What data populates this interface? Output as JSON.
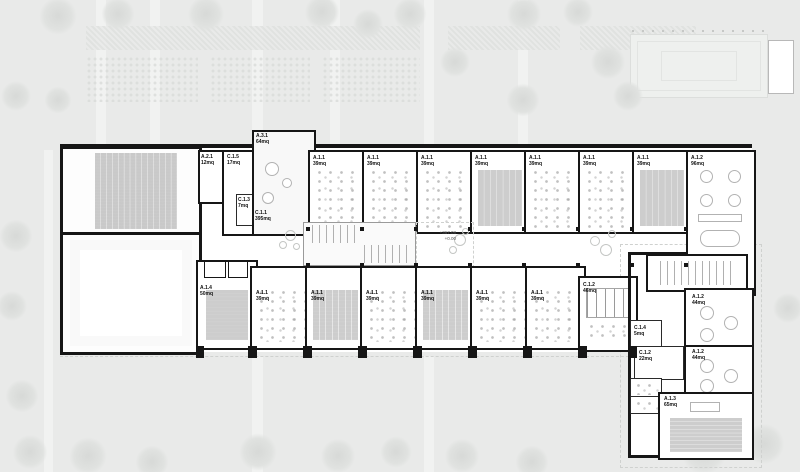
{
  "site": {
    "levels": {
      "upper": "+367.08",
      "zero": "+0.00"
    }
  },
  "rooms": [
    {
      "id": "A.2.1",
      "area": "12mq"
    },
    {
      "id": "C.1.5",
      "area": "17mq"
    },
    {
      "id": "C.1.3",
      "area": "7mq"
    },
    {
      "id": "A.3.1",
      "area": "64mq"
    },
    {
      "id": "C.1.1",
      "area": "395mq"
    },
    {
      "id": "A.1.1",
      "area": "39mq"
    },
    {
      "id": "A.1.1",
      "area": "39mq"
    },
    {
      "id": "A.1.1",
      "area": "39mq"
    },
    {
      "id": "A.1.1",
      "area": "39mq"
    },
    {
      "id": "A.1.1",
      "area": "39mq"
    },
    {
      "id": "A.1.1",
      "area": "39mq"
    },
    {
      "id": "A.1.1",
      "area": "39mq"
    },
    {
      "id": "A.1.2",
      "area": "96mq"
    },
    {
      "id": "A.1.4",
      "area": "50mq"
    },
    {
      "id": "A.1.1",
      "area": "39mq"
    },
    {
      "id": "A.1.1",
      "area": "39mq"
    },
    {
      "id": "A.1.1",
      "area": "39mq"
    },
    {
      "id": "A.1.1",
      "area": "39mq"
    },
    {
      "id": "A.1.1",
      "area": "39mq"
    },
    {
      "id": "A.1.1",
      "area": "39mq"
    },
    {
      "id": "C.1.2",
      "area": "46mq"
    },
    {
      "id": "C.1.4",
      "area": "5mq"
    },
    {
      "id": "C.1.2",
      "area": "22mq"
    },
    {
      "id": "A.1.2",
      "area": "44mq"
    },
    {
      "id": "A.1.2",
      "area": "44mq"
    },
    {
      "id": "A.1.3",
      "area": "65mq"
    }
  ]
}
